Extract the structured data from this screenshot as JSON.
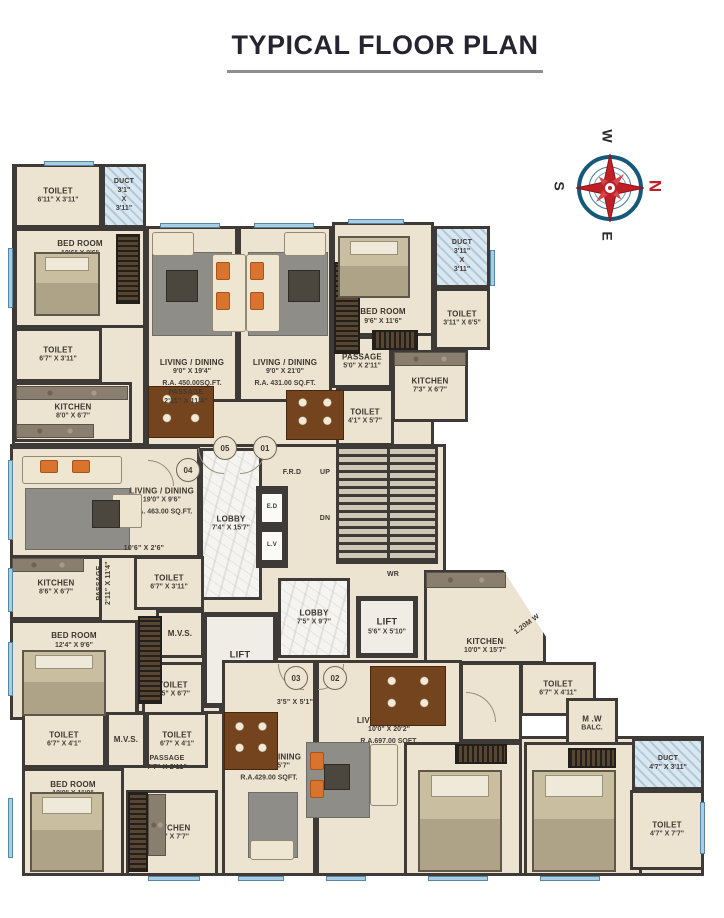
{
  "title": "TYPICAL FLOOR PLAN",
  "compass": {
    "n": "N",
    "e": "E",
    "s": "S",
    "w": "W"
  },
  "palette": {
    "wall": "#3d3a38",
    "floor": "#ece3d0",
    "window_blue": "#a9cde2",
    "marble": "#f5f4f1",
    "lift_floor": "#f0ede6",
    "duct_blue": "#d9e7f0",
    "compass_red": "#bf2026",
    "compass_blue": "#15597a",
    "title_color": "#262430",
    "underline_gray": "#8f8f8f"
  },
  "plan": {
    "slabs": [
      {
        "x": 12,
        "y": 164,
        "w": 134,
        "h": 282
      },
      {
        "x": 146,
        "y": 226,
        "w": 288,
        "h": 224
      },
      {
        "x": 10,
        "y": 444,
        "w": 436,
        "h": 262
      },
      {
        "x": 22,
        "y": 694,
        "w": 440,
        "h": 182
      },
      {
        "x": 404,
        "y": 736,
        "w": 300,
        "h": 140
      },
      {
        "x": 136,
        "y": 644,
        "w": 86,
        "h": 70
      },
      {
        "x": 460,
        "y": 662,
        "w": 62,
        "h": 80
      }
    ],
    "rooms": [
      {
        "n": "toilet-05-upper",
        "x": 14,
        "y": 164,
        "w": 88,
        "h": 64,
        "f": "beige",
        "lp": "c",
        "l": [
          "TOILET",
          "6'11\" X 3'11\""
        ]
      },
      {
        "n": "duct-05",
        "x": 102,
        "y": 164,
        "w": 44,
        "h": 64,
        "f": "duct",
        "lp": "c",
        "l": [
          "DUCT",
          "3'1\"",
          "X",
          "3'11\""
        ]
      },
      {
        "n": "bedroom-05",
        "x": 14,
        "y": 228,
        "w": 132,
        "h": 100,
        "f": "beige",
        "lp": "t",
        "l": [
          "BED ROOM",
          "10'6\" X 9'6\""
        ]
      },
      {
        "n": "toilet-05-lower",
        "x": 14,
        "y": 328,
        "w": 88,
        "h": 54,
        "f": "beige",
        "lp": "c",
        "l": [
          "TOILET",
          "6'7\" X 3'11\""
        ]
      },
      {
        "n": "kitchen-05",
        "x": 14,
        "y": 382,
        "w": 118,
        "h": 60,
        "f": "beige",
        "lp": "c",
        "l": [
          "KITCHEN",
          "8'0\" X 6'7\""
        ]
      },
      {
        "n": "living-05",
        "x": 146,
        "y": 226,
        "w": 92,
        "h": 176,
        "f": "beige",
        "lp": "b",
        "l": [
          "LIVING / DINING",
          "9'0\" X 19'4\"",
          "R.A. 450.00SQ.FT."
        ]
      },
      {
        "n": "living-01",
        "x": 238,
        "y": 226,
        "w": 94,
        "h": 176,
        "f": "beige",
        "lp": "b",
        "l": [
          "LIVING / DINING",
          "9'0\" X 21'0\"",
          "R.A. 431.00 SQ.FT."
        ]
      },
      {
        "n": "bedroom-01",
        "x": 332,
        "y": 222,
        "w": 102,
        "h": 114,
        "f": "beige",
        "lp": "b",
        "l": [
          "BED ROOM",
          "9'6\" X 11'6\""
        ]
      },
      {
        "n": "duct-01",
        "x": 434,
        "y": 226,
        "w": 56,
        "h": 62,
        "f": "duct",
        "lp": "c",
        "l": [
          "DUCT",
          "3'11\"",
          "X",
          "3'11\""
        ]
      },
      {
        "n": "toilet-01-upper",
        "x": 434,
        "y": 288,
        "w": 56,
        "h": 62,
        "f": "beige",
        "lp": "c",
        "l": [
          "TOILET",
          "3'11\" X 6'5\""
        ]
      },
      {
        "n": "passage-01",
        "x": 332,
        "y": 336,
        "w": 60,
        "h": 52,
        "f": "beige",
        "lp": "c",
        "l": [
          "PASSAGE",
          "5'0\" X 2'11\""
        ]
      },
      {
        "n": "kitchen-01",
        "x": 392,
        "y": 350,
        "w": 76,
        "h": 72,
        "f": "beige",
        "lp": "c",
        "l": [
          "KITCHEN",
          "7'3\" X 6'7\""
        ]
      },
      {
        "n": "toilet-01-lower",
        "x": 336,
        "y": 388,
        "w": 58,
        "h": 58,
        "f": "beige",
        "lp": "c",
        "l": [
          "TOILET",
          "4'1\" X 5'7\""
        ]
      },
      {
        "n": "lobby-upper",
        "x": 200,
        "y": 448,
        "w": 62,
        "h": 152,
        "f": "marble",
        "lp": "c",
        "l": [
          "LOBBY",
          "7'4\" X 15'7\""
        ]
      },
      {
        "n": "shaft-block",
        "x": 256,
        "y": 486,
        "w": 32,
        "h": 82,
        "f": "wall",
        "lp": "c",
        "l": []
      },
      {
        "n": "shaft-ed",
        "x": 260,
        "y": 492,
        "w": 24,
        "h": 32,
        "f": "shaft",
        "lp": "c",
        "l": [
          "E.D"
        ]
      },
      {
        "n": "shaft-lv",
        "x": 260,
        "y": 530,
        "w": 24,
        "h": 32,
        "f": "shaft",
        "lp": "c",
        "l": [
          "L.V"
        ]
      },
      {
        "n": "lobby-lower",
        "x": 278,
        "y": 578,
        "w": 72,
        "h": 80,
        "f": "marble",
        "lp": "c",
        "l": [
          "LOBBY",
          "7'5\" X 9'7\""
        ]
      },
      {
        "n": "lift-main",
        "x": 202,
        "y": 612,
        "w": 76,
        "h": 96,
        "f": "lift",
        "lp": "c",
        "l": [
          "LIFT",
          "6'4\" X 8'2\""
        ]
      },
      {
        "n": "lift-2",
        "x": 356,
        "y": 596,
        "w": 62,
        "h": 62,
        "f": "lift",
        "lp": "c",
        "l": [
          "LIFT",
          "5'6\" X 5'10\""
        ]
      },
      {
        "n": "living-04",
        "x": 10,
        "y": 446,
        "w": 190,
        "h": 112,
        "f": "beige",
        "lp": "r",
        "l": [
          "LIVING / DINING",
          "19'0\" X 9'6\"",
          "R.A. 463.00 SQ.FT."
        ]
      },
      {
        "n": "kitchen-04",
        "x": 10,
        "y": 556,
        "w": 92,
        "h": 64,
        "f": "beige",
        "lp": "c",
        "l": [
          "KITCHEN",
          "8'6\" X 6'7\""
        ]
      },
      {
        "n": "toilet-04-upper",
        "x": 134,
        "y": 556,
        "w": 70,
        "h": 54,
        "f": "beige",
        "lp": "c",
        "l": [
          "TOILET",
          "6'7\" X 3'11\""
        ]
      },
      {
        "n": "mvs-04",
        "x": 156,
        "y": 610,
        "w": 48,
        "h": 48,
        "f": "beige",
        "lp": "c",
        "l": [
          "M.V.S."
        ]
      },
      {
        "n": "bedroom-04",
        "x": 10,
        "y": 620,
        "w": 128,
        "h": 100,
        "f": "beige",
        "lp": "t",
        "l": [
          "BED ROOM",
          "12'4\" X 9'6\""
        ]
      },
      {
        "n": "toilet-04-lower",
        "x": 142,
        "y": 662,
        "w": 62,
        "h": 56,
        "f": "beige",
        "lp": "c",
        "l": [
          "TOILET",
          "3'5\" X 6'7\""
        ]
      },
      {
        "n": "kitchen-02",
        "x": 424,
        "y": 570,
        "w": 122,
        "h": 94,
        "f": "beige",
        "lp": "b",
        "clip": "polygon(0 0, 65% 0, 100% 71%, 100% 100%, 0 100%)",
        "l": [
          "KITCHEN",
          "10'0\" X 15'7\""
        ]
      },
      {
        "n": "toilet-02-upper",
        "x": 520,
        "y": 662,
        "w": 76,
        "h": 54,
        "f": "beige",
        "lp": "c",
        "l": [
          "TOILET",
          "6'7\" X 4'11\""
        ]
      },
      {
        "n": "mw-balcony",
        "x": 566,
        "y": 698,
        "w": 52,
        "h": 52,
        "f": "beige",
        "lp": "c",
        "l": [
          "M .W",
          "BALC."
        ]
      },
      {
        "n": "living-02",
        "x": 316,
        "y": 660,
        "w": 146,
        "h": 216,
        "f": "beige",
        "lp": "tm",
        "l": [
          "LIVING / DINING",
          "10'0\" X 20'2\"",
          "R.A.697.00 SQFT."
        ]
      },
      {
        "n": "living-03",
        "x": 222,
        "y": 660,
        "w": 94,
        "h": 216,
        "f": "beige",
        "lp": "c",
        "l": [
          "LIVING / DINING",
          "10'0\" X 15'7\"",
          "R.A.429.00 SQFT."
        ]
      },
      {
        "n": "bedroom-02a",
        "x": 404,
        "y": 742,
        "w": 118,
        "h": 134,
        "f": "beige",
        "lp": "tm",
        "l": [
          "BED ROOM",
          "10'0\" X 12'2\""
        ]
      },
      {
        "n": "bedroom-02b",
        "x": 524,
        "y": 742,
        "w": 118,
        "h": 134,
        "f": "beige",
        "lp": "tm",
        "l": [
          "BED ROOM",
          "10'0\" X 12'0\""
        ]
      },
      {
        "n": "duct-02",
        "x": 632,
        "y": 738,
        "w": 72,
        "h": 52,
        "f": "duct",
        "lp": "c",
        "l": [
          "DUCT",
          "4'7\" X 3'11\""
        ]
      },
      {
        "n": "toilet-02-lower",
        "x": 630,
        "y": 790,
        "w": 74,
        "h": 80,
        "f": "beige",
        "lp": "c",
        "l": [
          "TOILET",
          "4'7\" X 7'7\""
        ]
      },
      {
        "n": "toilet-03a",
        "x": 22,
        "y": 712,
        "w": 84,
        "h": 56,
        "f": "beige",
        "lp": "c",
        "l": [
          "TOILET",
          "6'7\" X 4'1\""
        ]
      },
      {
        "n": "mvs-03",
        "x": 106,
        "y": 712,
        "w": 40,
        "h": 56,
        "f": "beige",
        "lp": "c",
        "l": [
          "M.V.S."
        ]
      },
      {
        "n": "toilet-03b",
        "x": 146,
        "y": 712,
        "w": 62,
        "h": 56,
        "f": "beige",
        "lp": "c",
        "l": [
          "TOILET",
          "6'7\" X 4'1\""
        ]
      },
      {
        "n": "bedroom-03",
        "x": 22,
        "y": 768,
        "w": 102,
        "h": 108,
        "f": "beige",
        "lp": "t",
        "l": [
          "BED ROOM",
          "10'0\" X 11'0\""
        ]
      },
      {
        "n": "kitchen-03",
        "x": 126,
        "y": 790,
        "w": 92,
        "h": 86,
        "f": "beige",
        "lp": "c",
        "l": [
          "KITCHEN",
          "8'7\" X 7'7\""
        ]
      }
    ],
    "furniture": [
      {
        "t": "stairs",
        "x": 336,
        "y": 446,
        "w": 102,
        "h": 118
      },
      {
        "t": "ward",
        "x": 116,
        "y": 234,
        "w": 24,
        "h": 70
      },
      {
        "t": "ward",
        "x": 334,
        "y": 262,
        "w": 26,
        "h": 92
      },
      {
        "t": "ward",
        "x": 138,
        "y": 616,
        "w": 24,
        "h": 88
      },
      {
        "t": "ward",
        "x": 128,
        "y": 792,
        "w": 20,
        "h": 80
      },
      {
        "t": "ward-h",
        "x": 372,
        "y": 330,
        "w": 46,
        "h": 20
      },
      {
        "t": "ward-h",
        "x": 455,
        "y": 744,
        "w": 52,
        "h": 20
      },
      {
        "t": "ward-h",
        "x": 568,
        "y": 748,
        "w": 48,
        "h": 20
      },
      {
        "t": "bed",
        "x": 34,
        "y": 252,
        "w": 66,
        "h": 64
      },
      {
        "t": "bed",
        "x": 338,
        "y": 236,
        "w": 72,
        "h": 62
      },
      {
        "t": "bed",
        "x": 22,
        "y": 650,
        "w": 84,
        "h": 66
      },
      {
        "t": "bed",
        "x": 30,
        "y": 792,
        "w": 74,
        "h": 80
      },
      {
        "t": "bed",
        "x": 418,
        "y": 770,
        "w": 84,
        "h": 102
      },
      {
        "t": "bed",
        "x": 532,
        "y": 770,
        "w": 84,
        "h": 102
      },
      {
        "t": "rug",
        "x": 152,
        "y": 252,
        "w": 80,
        "h": 84
      },
      {
        "t": "rug",
        "x": 248,
        "y": 252,
        "w": 80,
        "h": 84
      },
      {
        "t": "rug",
        "x": 25,
        "y": 488,
        "w": 105,
        "h": 62
      },
      {
        "t": "rug",
        "x": 306,
        "y": 742,
        "w": 64,
        "h": 76
      },
      {
        "t": "rug",
        "x": 248,
        "y": 792,
        "w": 50,
        "h": 66
      },
      {
        "t": "sofa",
        "x": 152,
        "y": 232,
        "w": 42,
        "h": 24
      },
      {
        "t": "sofa",
        "x": 284,
        "y": 232,
        "w": 42,
        "h": 24
      },
      {
        "t": "sofa",
        "x": 22,
        "y": 456,
        "w": 100,
        "h": 28
      },
      {
        "t": "sofa",
        "x": 212,
        "y": 254,
        "w": 34,
        "h": 78
      },
      {
        "t": "sofa",
        "x": 246,
        "y": 254,
        "w": 34,
        "h": 78
      },
      {
        "t": "sofa",
        "x": 370,
        "y": 744,
        "w": 28,
        "h": 62
      },
      {
        "t": "sofa",
        "x": 250,
        "y": 840,
        "w": 44,
        "h": 20
      },
      {
        "t": "chair",
        "x": 112,
        "y": 494,
        "w": 30,
        "h": 34
      },
      {
        "t": "orange",
        "x": 216,
        "y": 262,
        "w": 14,
        "h": 18
      },
      {
        "t": "orange",
        "x": 216,
        "y": 292,
        "w": 14,
        "h": 18
      },
      {
        "t": "orange",
        "x": 250,
        "y": 262,
        "w": 14,
        "h": 18
      },
      {
        "t": "orange",
        "x": 250,
        "y": 292,
        "w": 14,
        "h": 18
      },
      {
        "t": "orange",
        "x": 40,
        "y": 460,
        "w": 18,
        "h": 13
      },
      {
        "t": "orange",
        "x": 72,
        "y": 460,
        "w": 18,
        "h": 13
      },
      {
        "t": "orange",
        "x": 310,
        "y": 752,
        "w": 14,
        "h": 18
      },
      {
        "t": "orange",
        "x": 310,
        "y": 780,
        "w": 14,
        "h": 18
      },
      {
        "t": "tbl",
        "x": 166,
        "y": 270,
        "w": 32,
        "h": 32
      },
      {
        "t": "tbl",
        "x": 288,
        "y": 270,
        "w": 32,
        "h": 32
      },
      {
        "t": "tbl",
        "x": 92,
        "y": 500,
        "w": 28,
        "h": 28
      },
      {
        "t": "tbl",
        "x": 324,
        "y": 764,
        "w": 26,
        "h": 26
      },
      {
        "t": "dining",
        "x": 148,
        "y": 386,
        "w": 66,
        "h": 52
      },
      {
        "t": "dining",
        "x": 286,
        "y": 390,
        "w": 58,
        "h": 50
      },
      {
        "t": "dining",
        "x": 370,
        "y": 666,
        "w": 76,
        "h": 60
      },
      {
        "t": "dining",
        "x": 224,
        "y": 712,
        "w": 54,
        "h": 58
      },
      {
        "t": "counter",
        "x": 16,
        "y": 386,
        "w": 112,
        "h": 14
      },
      {
        "t": "counter",
        "x": 16,
        "y": 424,
        "w": 78,
        "h": 14
      },
      {
        "t": "counter",
        "x": 12,
        "y": 558,
        "w": 72,
        "h": 14
      },
      {
        "t": "counter",
        "x": 394,
        "y": 352,
        "w": 72,
        "h": 14
      },
      {
        "t": "counter",
        "x": 426,
        "y": 572,
        "w": 80,
        "h": 16
      },
      {
        "t": "counter",
        "x": 148,
        "y": 794,
        "w": 18,
        "h": 62
      }
    ],
    "windows": [
      {
        "x": 8,
        "y": 248,
        "w": 5,
        "h": 60
      },
      {
        "x": 44,
        "y": 161,
        "w": 50,
        "h": 5
      },
      {
        "x": 160,
        "y": 223,
        "w": 60,
        "h": 5
      },
      {
        "x": 254,
        "y": 223,
        "w": 60,
        "h": 5
      },
      {
        "x": 348,
        "y": 219,
        "w": 56,
        "h": 5
      },
      {
        "x": 490,
        "y": 250,
        "w": 5,
        "h": 36
      },
      {
        "x": 8,
        "y": 460,
        "w": 5,
        "h": 80
      },
      {
        "x": 8,
        "y": 568,
        "w": 5,
        "h": 44
      },
      {
        "x": 8,
        "y": 642,
        "w": 5,
        "h": 54
      },
      {
        "x": 8,
        "y": 798,
        "w": 5,
        "h": 60
      },
      {
        "x": 148,
        "y": 876,
        "w": 52,
        "h": 5
      },
      {
        "x": 238,
        "y": 876,
        "w": 46,
        "h": 5
      },
      {
        "x": 326,
        "y": 876,
        "w": 40,
        "h": 5
      },
      {
        "x": 428,
        "y": 876,
        "w": 60,
        "h": 5
      },
      {
        "x": 540,
        "y": 876,
        "w": 60,
        "h": 5
      },
      {
        "x": 700,
        "y": 802,
        "w": 5,
        "h": 52
      }
    ],
    "doors": [
      {
        "x": 198,
        "y": 448,
        "r": 26,
        "q": "bl"
      },
      {
        "x": 240,
        "y": 448,
        "r": 26,
        "q": "br"
      },
      {
        "x": 148,
        "y": 460,
        "r": 26,
        "q": "tr"
      },
      {
        "x": 278,
        "y": 664,
        "r": 26,
        "q": "bl"
      },
      {
        "x": 318,
        "y": 664,
        "r": 26,
        "q": "br"
      },
      {
        "x": 466,
        "y": 692,
        "r": 30,
        "q": "tr"
      }
    ],
    "labels": [
      {
        "n": "passage-top",
        "x": 150,
        "y": 388,
        "w": 72,
        "lines": [
          "PASSAGE",
          "2'11\" X 11'4\""
        ]
      },
      {
        "n": "frd",
        "x": 272,
        "y": 468,
        "w": 40,
        "lines": [
          "F.R.D"
        ]
      },
      {
        "n": "up",
        "x": 308,
        "y": 468,
        "w": 34,
        "lines": [
          "UP"
        ]
      },
      {
        "n": "dn",
        "x": 308,
        "y": 514,
        "w": 34,
        "lines": [
          "DN"
        ]
      },
      {
        "n": "wr",
        "x": 376,
        "y": 570,
        "w": 34,
        "lines": [
          "WR"
        ]
      },
      {
        "n": "passage-left",
        "x": 70,
        "y": 574,
        "w": 68,
        "rot": -90,
        "lines": [
          "PASSAGE",
          "2'11\" X 11'4\""
        ]
      },
      {
        "n": "dim-106",
        "x": 112,
        "y": 544,
        "w": 64,
        "lines": [
          "10'6\" X 2'6\""
        ]
      },
      {
        "n": "passage-03",
        "x": 132,
        "y": 754,
        "w": 70,
        "lines": [
          "PASSAGE",
          "7'7\" X 2'11\""
        ]
      },
      {
        "n": "dim-35",
        "x": 264,
        "y": 698,
        "w": 62,
        "lines": [
          "3'5\" X 5'1\""
        ]
      },
      {
        "n": "balc-width",
        "x": 498,
        "y": 620,
        "w": 58,
        "rot": -36,
        "lines": [
          "1.20M W"
        ]
      }
    ],
    "markers": [
      {
        "text": "05",
        "x": 213,
        "y": 436
      },
      {
        "text": "01",
        "x": 253,
        "y": 436
      },
      {
        "text": "04",
        "x": 176,
        "y": 458
      },
      {
        "text": "03",
        "x": 284,
        "y": 666
      },
      {
        "text": "02",
        "x": 323,
        "y": 666
      }
    ]
  }
}
